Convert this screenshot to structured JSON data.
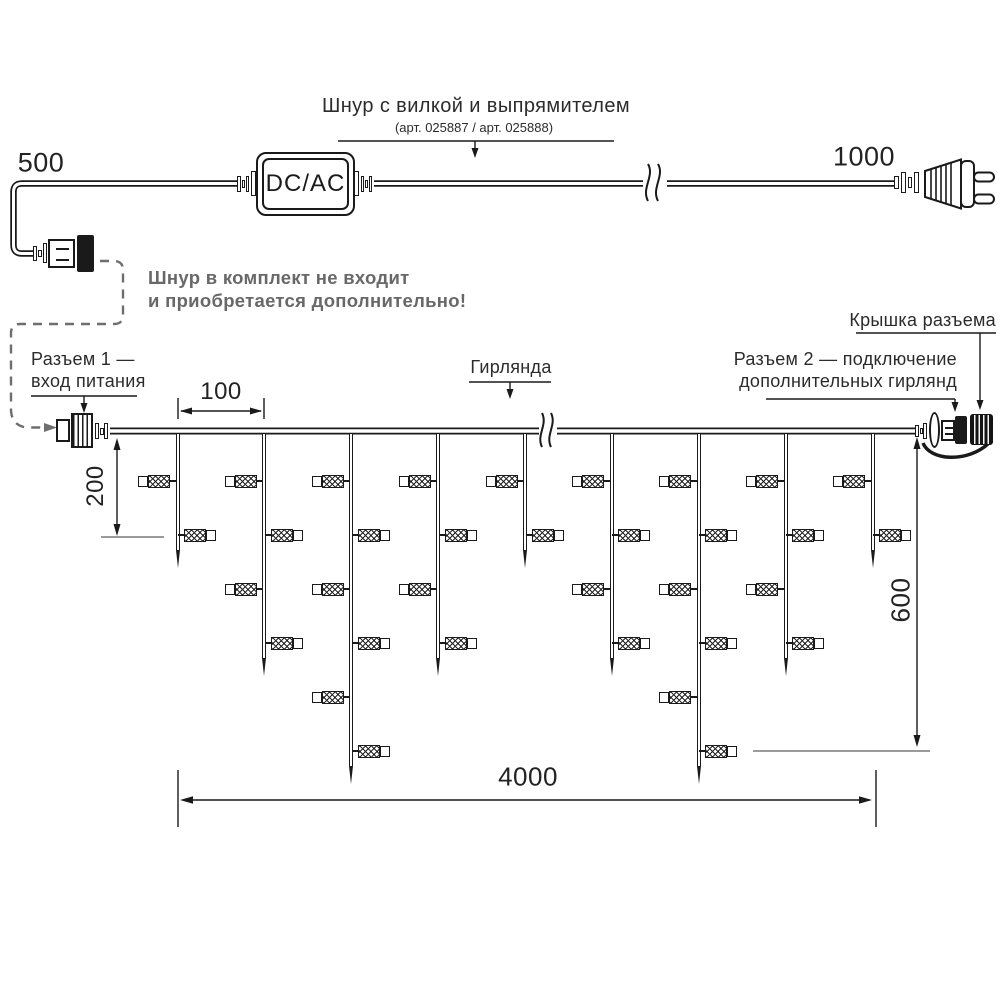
{
  "colors": {
    "line": "#1a1a1a",
    "note_gray": "#686868"
  },
  "power_cord": {
    "length_left_label": "500",
    "length_right_label": "1000",
    "converter_label": "DC/AC",
    "title": "Шнур с вилкой и выпрямителем",
    "subtitle": "(арт. 025887 / арт. 025888)",
    "note_line1": "Шнур в комплект не входит",
    "note_line2": "и приобретается дополнительно!"
  },
  "garland_labels": {
    "connector1_line1": "Разъем 1 —",
    "connector1_line2": "вход питания",
    "garland": "Гирлянда",
    "connector_cap": "Крышка разъема",
    "connector2_line1": "Разъем 2 — подключение",
    "connector2_line2": "дополнительных гирлянд"
  },
  "dimensions": {
    "drop_spacing": "100",
    "short_drop": "200",
    "long_drop": "600",
    "total_length": "4000"
  },
  "garland": {
    "drops": [
      {
        "lamps": 2
      },
      {
        "lamps": 4
      },
      {
        "lamps": 6
      },
      {
        "lamps": 4
      },
      {
        "lamps": 2
      },
      {
        "lamps": 4
      },
      {
        "lamps": 6
      },
      {
        "lamps": 4
      },
      {
        "lamps": 2
      }
    ]
  }
}
